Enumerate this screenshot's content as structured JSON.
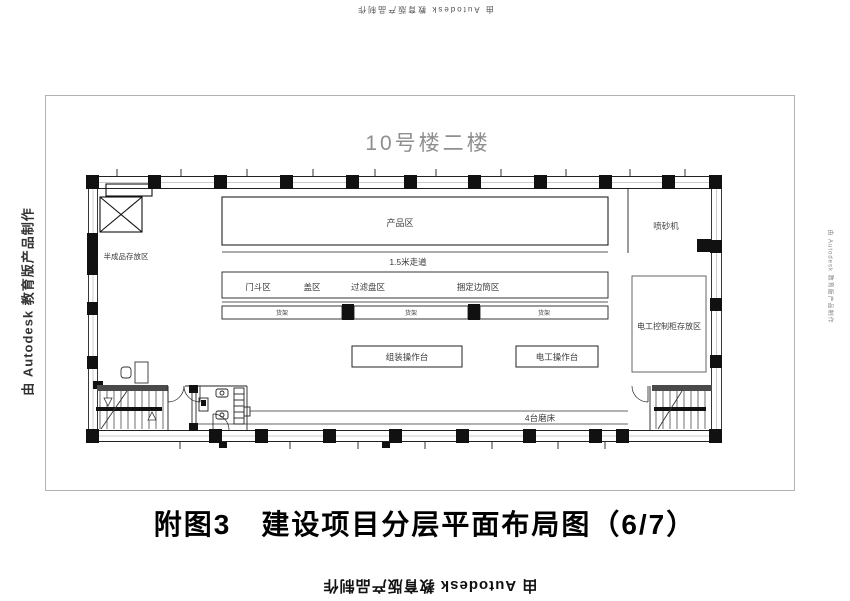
{
  "watermark": {
    "text": "由 Autodesk 教育版产品制作"
  },
  "caption": "附图3　建设项目分层平面布局图（6/7）",
  "plan": {
    "title": "10号楼二楼",
    "labels": {
      "product_area": "产品区",
      "walkway": "1.5米走道",
      "semi_finished_storage": "半成品存放区",
      "sandblaster": "喷砂机",
      "control_cabinet_storage": "电工控制柜存放区",
      "assembly_bench": "组装操作台",
      "electrician_bench": "电工操作台",
      "grinders": "4台磨床",
      "shelf": "货架",
      "zone_row": [
        "门斗区",
        "盖区",
        "过滤盘区",
        "捆定边筒区"
      ]
    }
  },
  "colors": {
    "line": "#222222",
    "column": "#111111",
    "label": "#3a3a3a",
    "title_gray": "#8f8f8f"
  }
}
